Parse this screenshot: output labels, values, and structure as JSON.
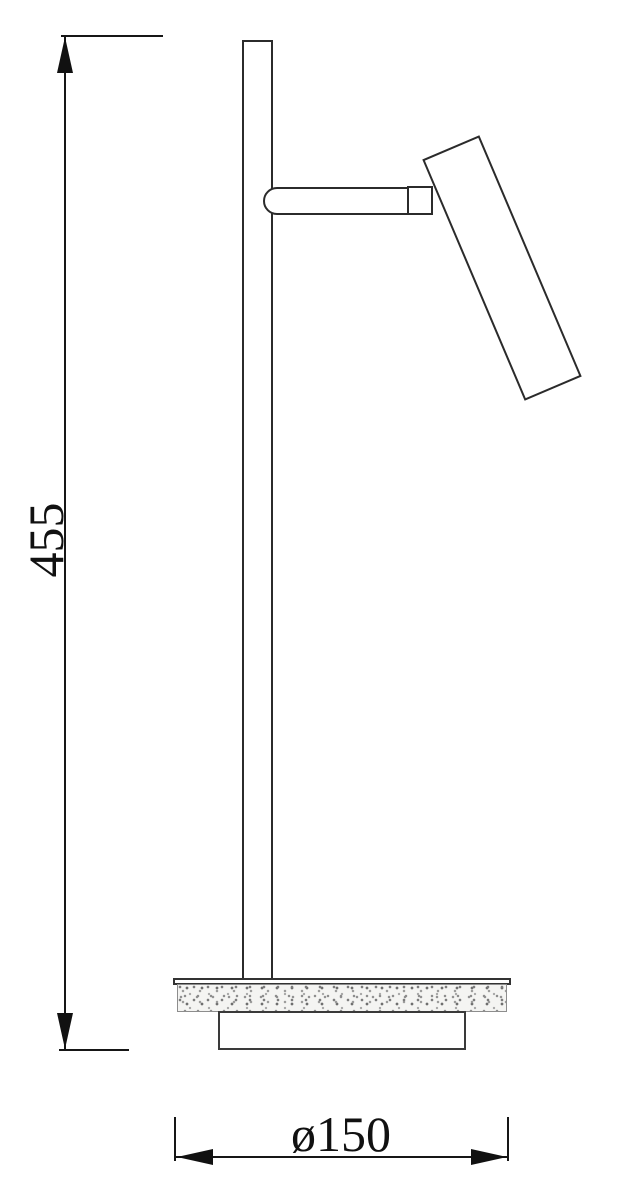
{
  "drawing": {
    "title": "table-lamp-dimension-drawing",
    "view": "side-elevation"
  },
  "dimensions": {
    "height": {
      "value": "455",
      "orientation": "vertical",
      "measured_from": "base-bottom",
      "measured_to": "pole-top"
    },
    "diameter": {
      "label": "ø150",
      "value": "150",
      "symbol": "ø",
      "orientation": "horizontal",
      "measures": "base-disc"
    }
  },
  "colors": {
    "background": "#ffffff",
    "line": "#2b2b2b",
    "dimension_line": "#161616",
    "stipple": "#8a8a8a"
  }
}
